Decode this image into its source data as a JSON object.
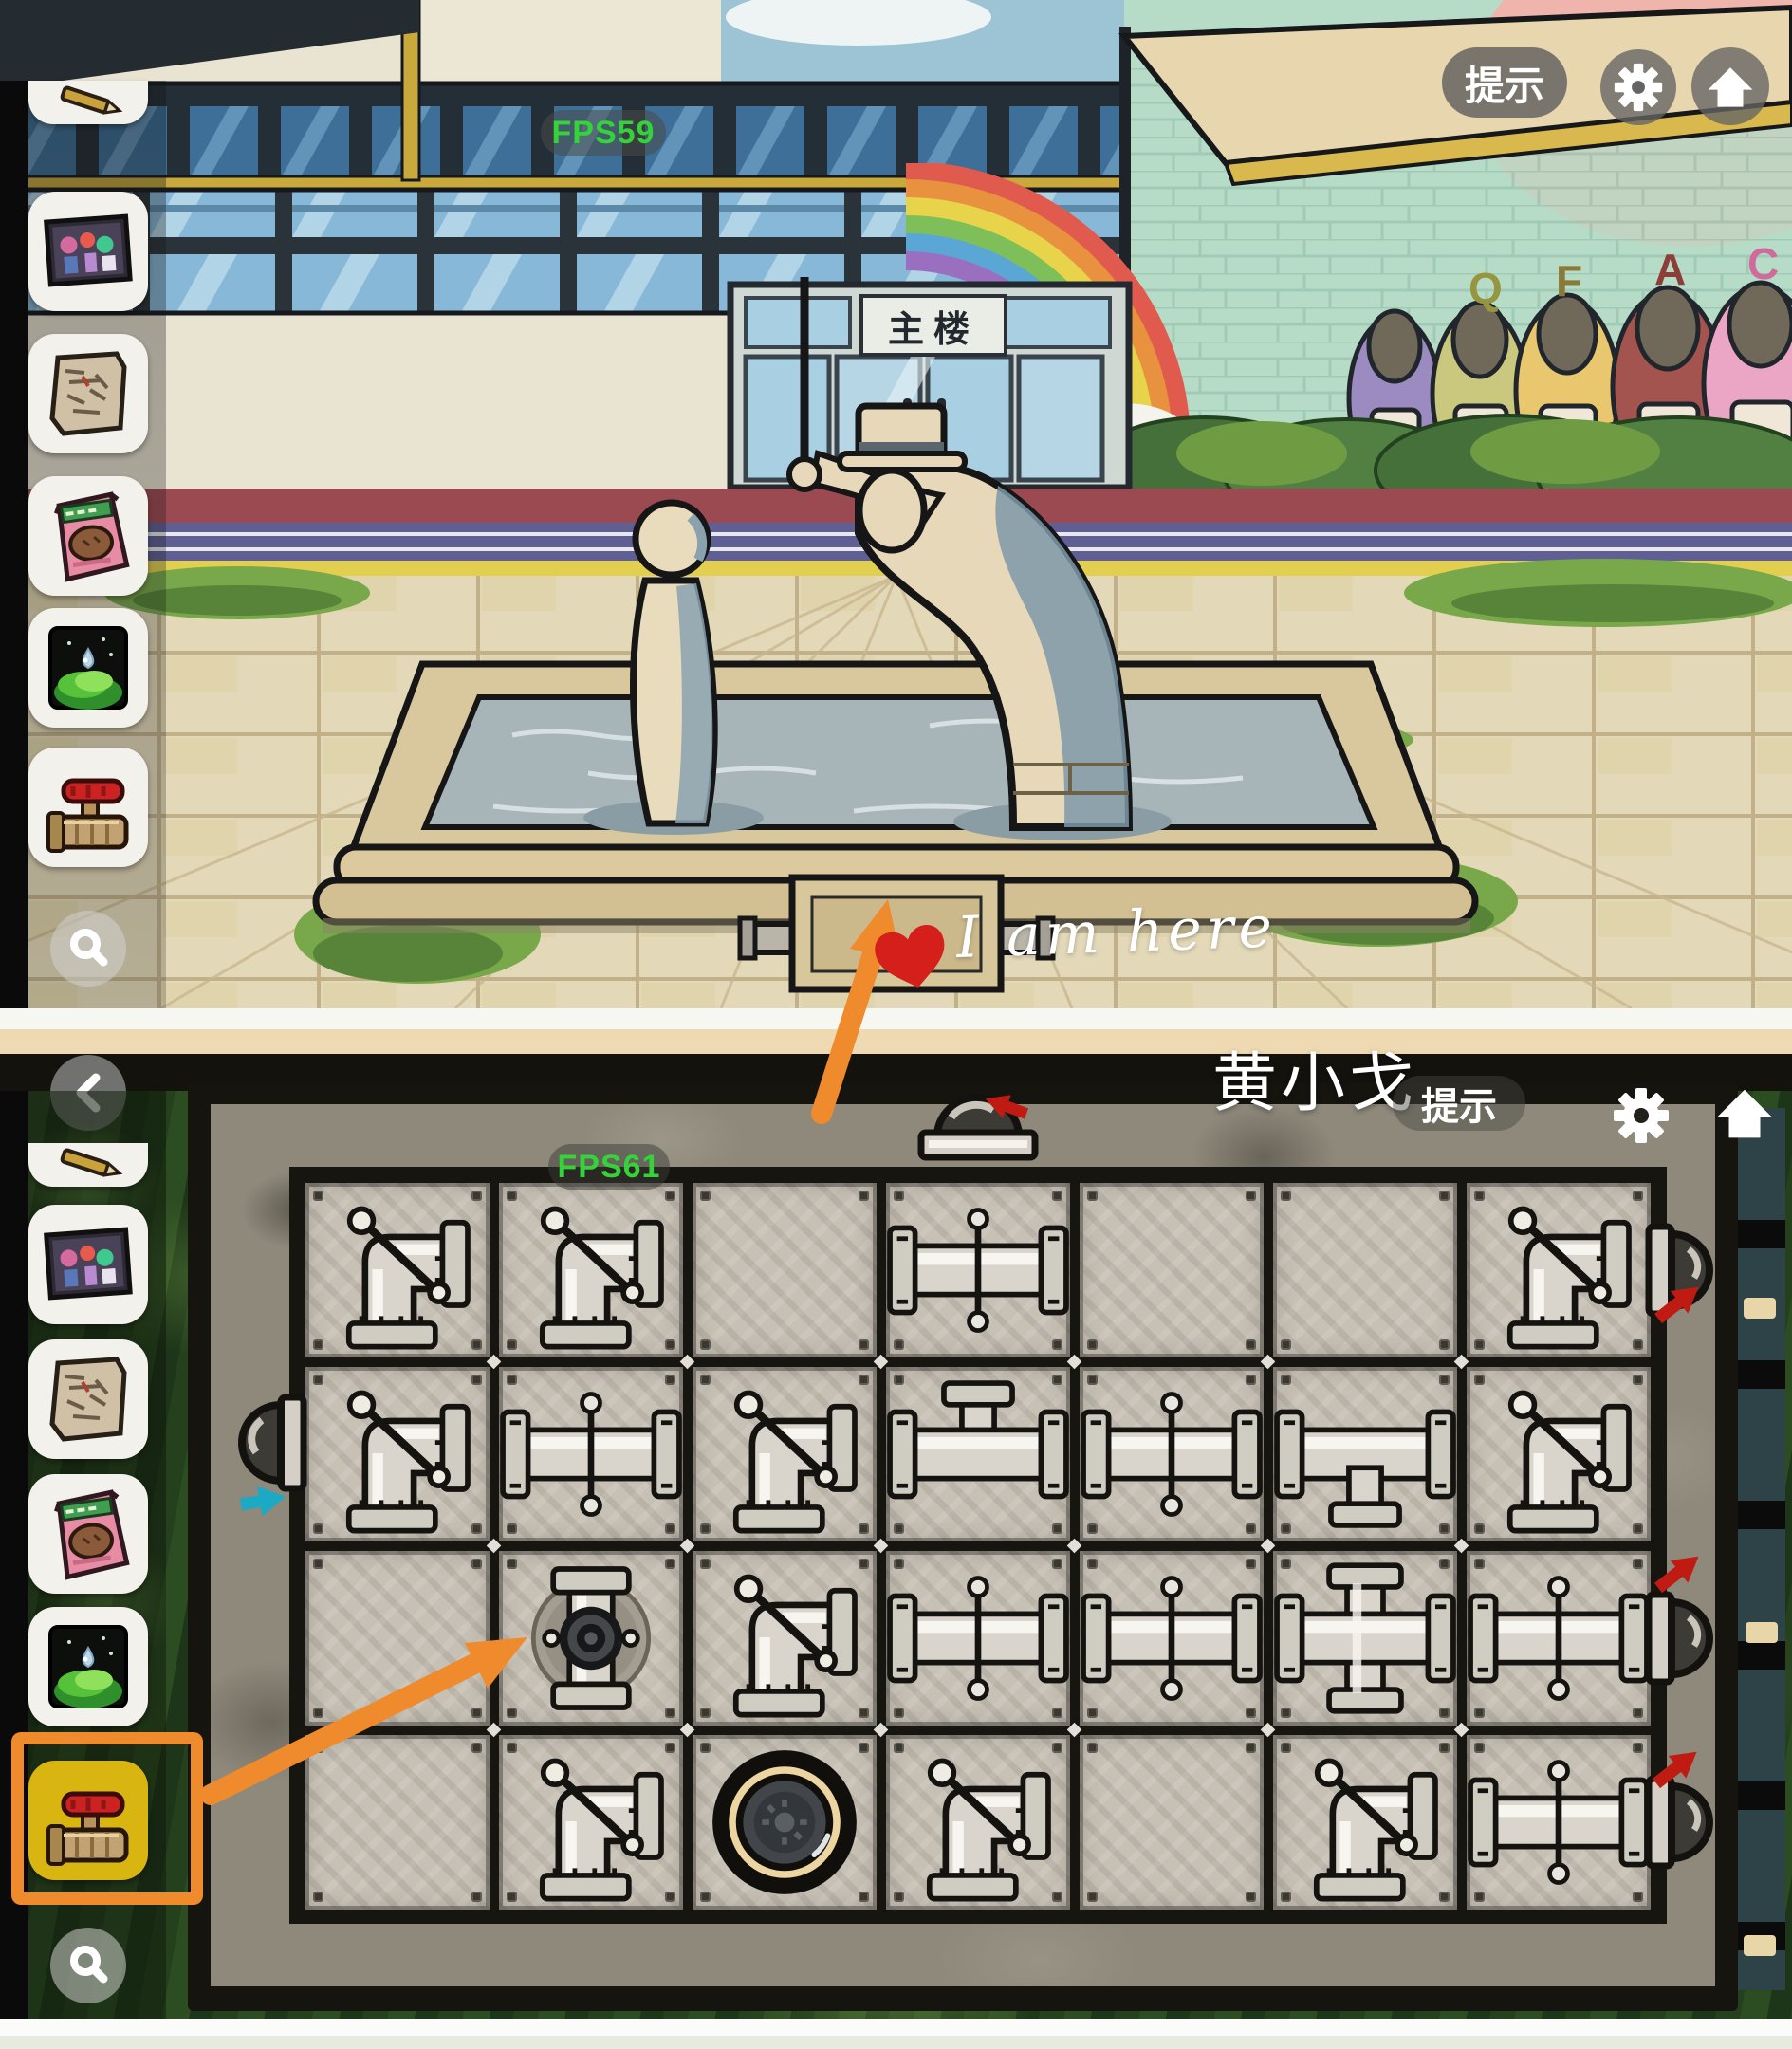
{
  "top_scene": {
    "fps": "FPS59",
    "hint_button": "提示",
    "door_sign": "主楼",
    "mural_letters": [
      "Q",
      "F",
      "A",
      "C"
    ]
  },
  "bottom_scene": {
    "fps": "FPS61",
    "hint_button": "提示"
  },
  "annotations": {
    "i_am_here": "I am here",
    "watermark": "黄小戈",
    "arrow_color": "#ef8b2d",
    "heart_color": "#d41f1b",
    "red_arrow_color": "#c01b12",
    "cyan_arrow_color": "#1ca9c4"
  },
  "inventory": {
    "top_items": [
      {
        "id": "pencil",
        "name": "pencil-item",
        "partial": true
      },
      {
        "id": "photo",
        "name": "photo-item"
      },
      {
        "id": "scroll",
        "name": "scroll-item"
      },
      {
        "id": "snack",
        "name": "snack-item"
      },
      {
        "id": "moss",
        "name": "moss-item"
      },
      {
        "id": "valve",
        "name": "valve-item"
      }
    ],
    "bottom_items": [
      {
        "id": "pencil",
        "name": "pencil-item",
        "partial": true
      },
      {
        "id": "photo",
        "name": "photo-item"
      },
      {
        "id": "scroll",
        "name": "scroll-item"
      },
      {
        "id": "snack",
        "name": "snack-item"
      },
      {
        "id": "moss",
        "name": "moss-item"
      },
      {
        "id": "valve",
        "name": "valve-item",
        "selected": true
      }
    ],
    "selected_color": "#d9b512",
    "highlight_color": "#ef8b2d"
  },
  "puzzle": {
    "grid": [
      [
        "elbow",
        "elbow",
        "",
        "h",
        "",
        "",
        "elbow"
      ],
      [
        "elbow",
        "h",
        "elbow",
        "tee_up",
        "h",
        "tee_down",
        "elbow"
      ],
      [
        "",
        "valve_socket",
        "elbow",
        "h",
        "h",
        "cross",
        "h"
      ],
      [
        "",
        "elbow",
        "drain",
        "elbow",
        "",
        "elbow",
        "h"
      ]
    ],
    "ports": {
      "top_cols": [
        3
      ],
      "left_rows": [
        1
      ],
      "right_rows": [
        0,
        2,
        3
      ]
    }
  },
  "colors": {
    "fps_green": "#35d33a",
    "ui_gray": "rgba(100,100,100,0.78)",
    "stone": "#8e897b",
    "plate": "#c7c0b4",
    "pipe": "#d9d5cc",
    "drain_ring": "#ecd5a0",
    "grass_dark": "#24401d",
    "mint_wall": "#b6dcc8",
    "pavement": "#e3d8b8"
  }
}
